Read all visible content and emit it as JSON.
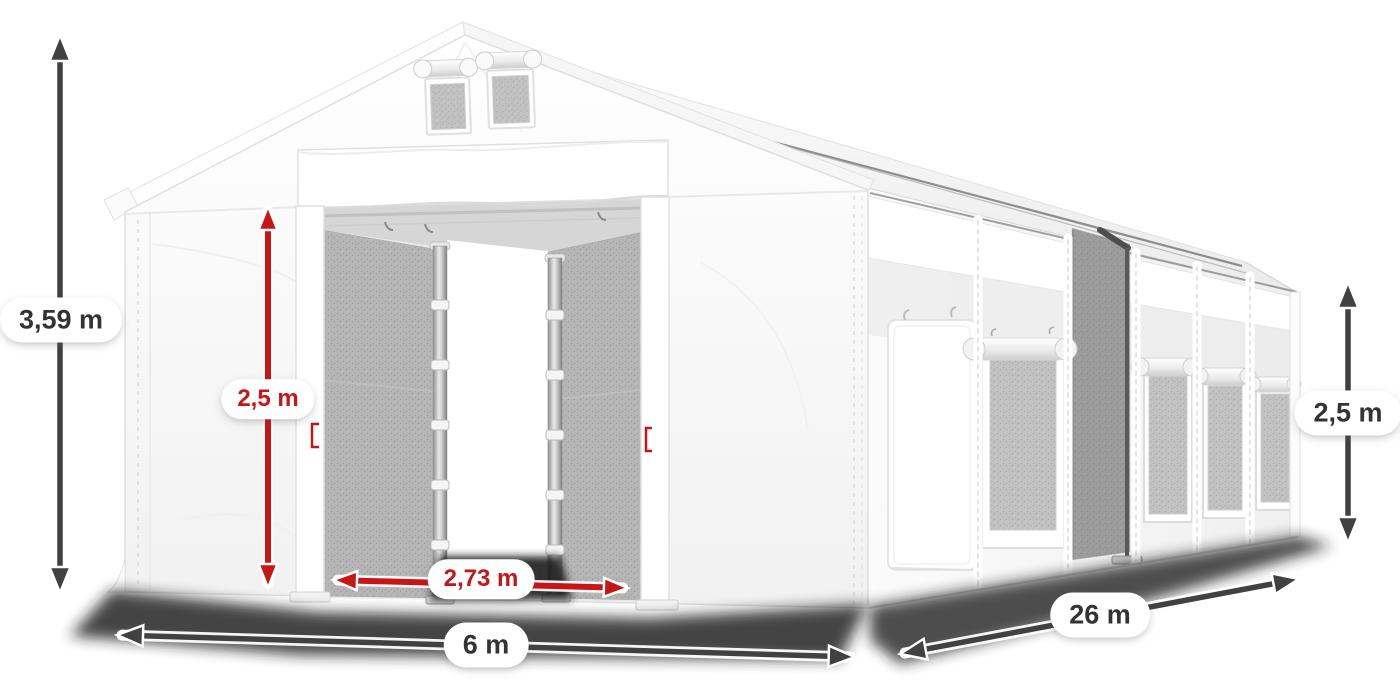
{
  "scene": {
    "description": "White PVC storage tent hall shown in perspective with measurement arrows",
    "background_color": "#ffffff"
  },
  "colors": {
    "dimension_red": "#c81515",
    "dimension_gray": "#414141",
    "label_text_dark": "#333333",
    "label_background": "#ffffff",
    "tent_fabric": "#ffffff",
    "mesh_gray": "#b6b6b6"
  },
  "dimension_labels": {
    "total_height": "3,59 m",
    "entrance_height": "2,5 m",
    "entrance_width": "2,73 m",
    "side_wall_height": "2,5 m",
    "tent_length": "26 m",
    "tent_width": "6 m"
  }
}
